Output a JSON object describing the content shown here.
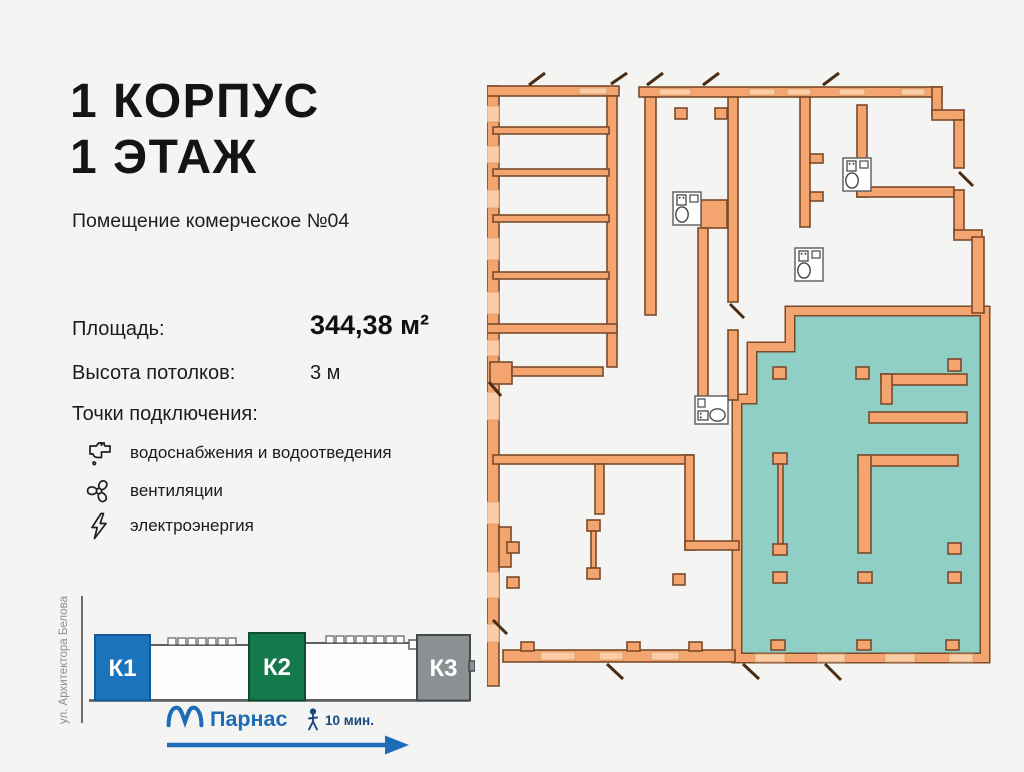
{
  "header": {
    "title_line1": "1 КОРПУС",
    "title_line2": "1 ЭТАЖ",
    "subtitle": "Помещение комерческое №04"
  },
  "specs": {
    "area_label": "Площадь:",
    "area_value": "344,38 м²",
    "ceiling_label": "Высота потолков:",
    "ceiling_value": "3 м",
    "connections_label": "Точки подключения:",
    "connections": [
      {
        "icon": "faucet-icon",
        "label": "водоснабжения и водоотведения"
      },
      {
        "icon": "fan-icon",
        "label": "вентиляции"
      },
      {
        "icon": "lightning-icon",
        "label": "электроэнергия"
      }
    ]
  },
  "site": {
    "street": "ул. Архитектора Белова",
    "blocks": [
      {
        "label": "К1",
        "color": "#1c75bc"
      },
      {
        "label": "К2",
        "color": "#157a4b"
      },
      {
        "label": "К3",
        "color": "#8b9093"
      }
    ],
    "metro_name": "Парнас",
    "walk_time": "10 мин.",
    "metro_color": "#1d6cb5"
  },
  "floorplan": {
    "highlight_color": "#90cfc5",
    "wall_color": "#f3a46f",
    "wall_outline": "#7b4a2b",
    "window_color": "#fbcda6"
  }
}
